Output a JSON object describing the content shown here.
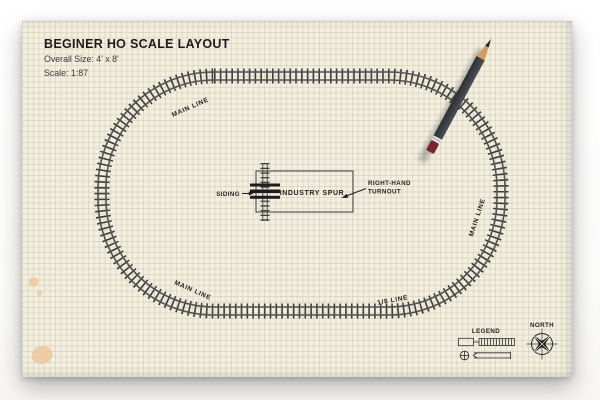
{
  "header": {
    "title": "BEGINER HO SCALE LAYOUT",
    "overall_size": "Overall Size: 4' x 8'",
    "scale": "Scale: 1:87"
  },
  "track_labels": {
    "top_left": "MAIN LINE",
    "bottom_left": "MAIN LINE",
    "right": "MAIN LINE",
    "bottom": "1/8 LINE"
  },
  "spur": {
    "siding_label": "SIDING",
    "industry_label": "INDUSTRY SPUR",
    "turnout_label_line1": "RIGHT-HAND",
    "turnout_label_line2": "TURNOUT"
  },
  "legend": {
    "title": "LEGEND"
  },
  "compass": {
    "label": "NORTH"
  },
  "colors": {
    "paper": "#f2efe1",
    "grid_line": "#dcd6bd",
    "tie": "#3d3d3d",
    "rail": "#525252",
    "ink": "#1f1f1f",
    "pencil_body": "#3b3e43",
    "pencil_wood": "#d59a62",
    "pencil_eraser": "#7b2531",
    "stain": "#eccaa2"
  }
}
